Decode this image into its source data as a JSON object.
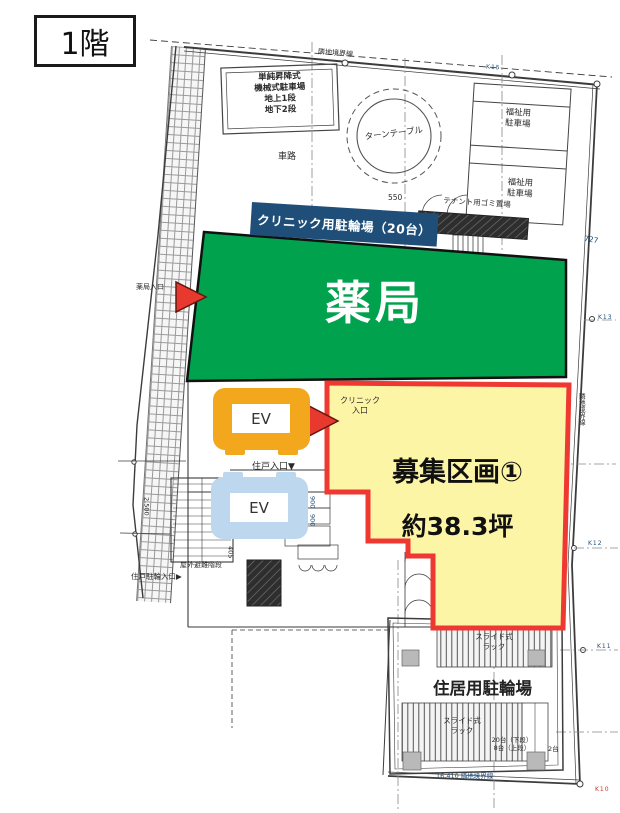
{
  "floor_badge": "1階",
  "zones": {
    "pharmacy": {
      "label": "薬局",
      "fill": "#00a24d"
    },
    "vacant": {
      "title": "募集区画①",
      "area": "約38.3坪",
      "fill": "#fdf5a6",
      "border": "#ee3831"
    },
    "clinic_bicycle_banner": {
      "label": "クリニック用駐輪場（20台）",
      "bg": "#1f4e79"
    },
    "elevator_upper": {
      "label": "EV",
      "fill": "#f2a71d"
    },
    "elevator_lower": {
      "label": "EV",
      "fill": "#bdd7ee"
    },
    "residential_bicycle": {
      "label": "住居用駐輪場"
    }
  },
  "plan_labels": {
    "mechanical_parking": "単純昇降式\n機械式駐車場\n地上1段\n地下2段",
    "driveway": "車路",
    "turntable": "ターンテーブル",
    "welfare_parking": "福祉用\n駐車場",
    "tenant_garbage": "テナント用ゴミ置場",
    "pharmacy_entrance": "薬局入口",
    "clinic_entrance": "クリニック\n入口",
    "unit_entrance": "住戸入口▼",
    "unit_bicycle_entrance": "住戸駐輪入口▶",
    "outdoor_escape_stairs": "屋外避難階段",
    "mail": "メール",
    "slide_rack": "スライド式\nラック",
    "rack_capacity": "20台（下段）\n8台（上段）",
    "rack_capacity_side": "2台"
  },
  "boundaries": {
    "top": "隣地境界線",
    "right": "隣地境界線",
    "bottom": "16,410 隣地境界線"
  },
  "dimensions": {
    "d550": "550",
    "d727": "727",
    "d405": "405",
    "d900a": "900",
    "d900b": "900",
    "d850": "850",
    "d2500": "2,500"
  },
  "survey_points": {
    "k15": "K15",
    "k13": "K13",
    "k12": "K12",
    "k11": "K11",
    "k10": "K10"
  },
  "colors": {
    "banner_bg": "#1f4e79",
    "pharmacy_green": "#00a24d",
    "vacant_yellow": "#fdf5a6",
    "vacant_border_red": "#ee3831",
    "arrow_red": "#e8392e",
    "ev_orange": "#f2a71d",
    "ev_blue": "#bdd7ee"
  }
}
